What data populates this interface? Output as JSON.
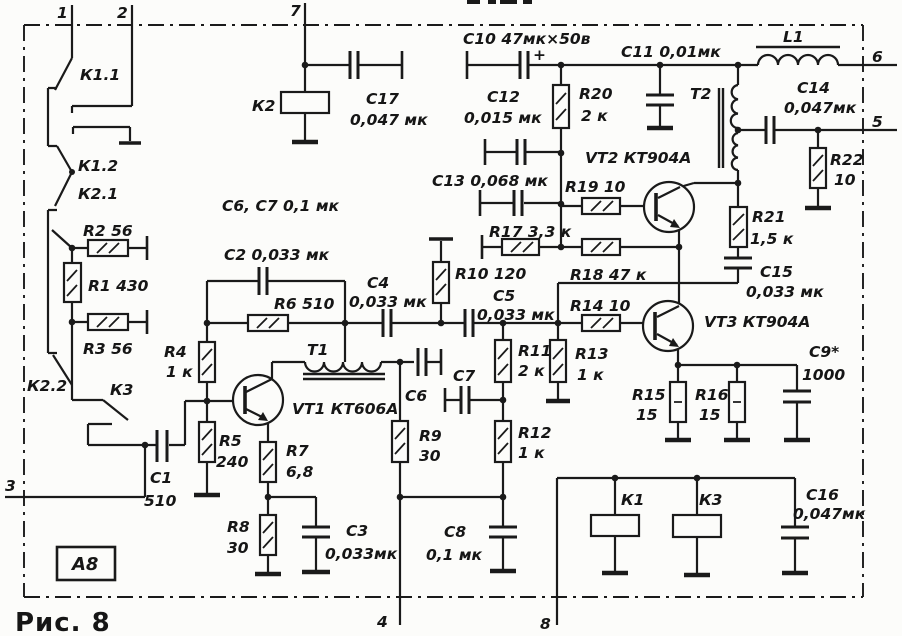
{
  "figure": {
    "caption": "Рис. 8",
    "module_label": "А8"
  },
  "labels": [
    {
      "n": "pin-1",
      "t": "1",
      "x": 57,
      "y": 18,
      "fs": 17
    },
    {
      "n": "pin-2",
      "t": "2",
      "x": 117,
      "y": 18,
      "fs": 17
    },
    {
      "n": "pin-7",
      "t": "7",
      "x": 290,
      "y": 16,
      "fs": 17
    },
    {
      "n": "pin-6",
      "t": "6",
      "x": 872,
      "y": 62,
      "fs": 17
    },
    {
      "n": "pin-5",
      "t": "5",
      "x": 872,
      "y": 127,
      "fs": 17
    },
    {
      "n": "pin-3",
      "t": "3",
      "x": 5,
      "y": 491,
      "fs": 17
    },
    {
      "n": "pin-4",
      "t": "4",
      "x": 377,
      "y": 627,
      "fs": 17
    },
    {
      "n": "pin-8",
      "t": "8",
      "x": 540,
      "y": 629,
      "fs": 17
    },
    {
      "n": "contact-K1-1",
      "t": "К1.1",
      "x": 80,
      "y": 80
    },
    {
      "n": "contact-K1-2",
      "t": "К1.2",
      "x": 78,
      "y": 171
    },
    {
      "n": "contact-K2-1",
      "t": "К2.1",
      "x": 78,
      "y": 199
    },
    {
      "n": "contact-K2-2",
      "t": "К2.2",
      "x": 27,
      "y": 391
    },
    {
      "n": "contact-K3",
      "t": "К3",
      "x": 110,
      "y": 395
    },
    {
      "n": "resistor-R2",
      "t": "R2 56",
      "x": 83,
      "y": 236
    },
    {
      "n": "resistor-R1",
      "t": "R1 430",
      "x": 88,
      "y": 291
    },
    {
      "n": "resistor-R3",
      "t": "R3 56",
      "x": 83,
      "y": 354
    },
    {
      "n": "capacitor-C1",
      "t": "С1",
      "x": 150,
      "y": 483
    },
    {
      "n": "capacitor-C1-val",
      "t": "510",
      "x": 144,
      "y": 506
    },
    {
      "n": "relay-K2",
      "t": "К2",
      "x": 252,
      "y": 111
    },
    {
      "n": "capacitor-C17",
      "t": "С17",
      "x": 366,
      "y": 104
    },
    {
      "n": "capacitor-C17-val",
      "t": "0,047 мк",
      "x": 350,
      "y": 125
    },
    {
      "n": "note-C6-C7",
      "t": "С6, С7  0,1 мк",
      "x": 222,
      "y": 211
    },
    {
      "n": "capacitor-C2",
      "t": "С2  0,033 мк",
      "x": 224,
      "y": 260
    },
    {
      "n": "resistor-R6",
      "t": "R6  510",
      "x": 274,
      "y": 309
    },
    {
      "n": "resistor-R4",
      "t": "R4",
      "x": 164,
      "y": 357
    },
    {
      "n": "resistor-R4-val",
      "t": "1 к",
      "x": 166,
      "y": 377
    },
    {
      "n": "resistor-R5",
      "t": "R5",
      "x": 219,
      "y": 446
    },
    {
      "n": "resistor-R5-val",
      "t": "240",
      "x": 216,
      "y": 467
    },
    {
      "n": "transistor-VT1",
      "t": "VT1  КТ606А",
      "x": 292,
      "y": 414
    },
    {
      "n": "transformer-T1",
      "t": "Т1",
      "x": 307,
      "y": 355
    },
    {
      "n": "resistor-R7",
      "t": "R7",
      "x": 286,
      "y": 456
    },
    {
      "n": "resistor-R7-val",
      "t": "6,8",
      "x": 286,
      "y": 477
    },
    {
      "n": "resistor-R8",
      "t": "R8",
      "x": 227,
      "y": 532
    },
    {
      "n": "resistor-R8-val",
      "t": "30",
      "x": 227,
      "y": 553
    },
    {
      "n": "capacitor-C3",
      "t": "С3",
      "x": 346,
      "y": 536
    },
    {
      "n": "capacitor-C3-val",
      "t": "0,033мк",
      "x": 325,
      "y": 559
    },
    {
      "n": "capacitor-C4",
      "t": "С4",
      "x": 367,
      "y": 288
    },
    {
      "n": "capacitor-C4-val",
      "t": "0,033 мк",
      "x": 349,
      "y": 307
    },
    {
      "n": "resistor-R10",
      "t": "R10 120",
      "x": 455,
      "y": 279
    },
    {
      "n": "capacitor-C5",
      "t": "С5",
      "x": 493,
      "y": 301
    },
    {
      "n": "capacitor-C5-val",
      "t": "0,033 мк",
      "x": 477,
      "y": 320
    },
    {
      "n": "capacitor-C6",
      "t": "С6",
      "x": 405,
      "y": 401
    },
    {
      "n": "capacitor-C7",
      "t": "С7",
      "x": 453,
      "y": 381
    },
    {
      "n": "resistor-R9",
      "t": "R9",
      "x": 419,
      "y": 441
    },
    {
      "n": "resistor-R9-val",
      "t": "30",
      "x": 419,
      "y": 461
    },
    {
      "n": "resistor-R11",
      "t": "R11",
      "x": 518,
      "y": 356
    },
    {
      "n": "resistor-R11-val",
      "t": "2 к",
      "x": 518,
      "y": 376
    },
    {
      "n": "resistor-R12",
      "t": "R12",
      "x": 518,
      "y": 438
    },
    {
      "n": "resistor-R12-val",
      "t": "1 к",
      "x": 518,
      "y": 458
    },
    {
      "n": "resistor-R13",
      "t": "R13",
      "x": 575,
      "y": 359
    },
    {
      "n": "resistor-R13-val",
      "t": "1 к",
      "x": 577,
      "y": 380
    },
    {
      "n": "capacitor-C8",
      "t": "С8",
      "x": 444,
      "y": 537
    },
    {
      "n": "capacitor-C8-val",
      "t": "0,1 мк",
      "x": 426,
      "y": 560
    },
    {
      "n": "resistor-R14",
      "t": "R14 10",
      "x": 570,
      "y": 311
    },
    {
      "n": "resistor-R18",
      "t": "R18 47 к",
      "x": 570,
      "y": 280
    },
    {
      "n": "resistor-R17",
      "t": "R17 3,3 к",
      "x": 489,
      "y": 237
    },
    {
      "n": "resistor-R19",
      "t": "R19 10",
      "x": 565,
      "y": 192
    },
    {
      "n": "capacitor-C13",
      "t": "С13 0,068 мк",
      "x": 432,
      "y": 186
    },
    {
      "n": "capacitor-C12",
      "t": "С12",
      "x": 487,
      "y": 102
    },
    {
      "n": "capacitor-C12-val",
      "t": "0,015 мк",
      "x": 464,
      "y": 123
    },
    {
      "n": "capacitor-C10",
      "t": "С10 47мк×50в",
      "x": 463,
      "y": 44
    },
    {
      "n": "capacitor-C10-plus",
      "t": "+",
      "x": 533,
      "y": 60
    },
    {
      "n": "resistor-R20",
      "t": "R20",
      "x": 579,
      "y": 99
    },
    {
      "n": "resistor-R20-val",
      "t": "2 к",
      "x": 581,
      "y": 121
    },
    {
      "n": "capacitor-C11",
      "t": "С11 0,01мк",
      "x": 621,
      "y": 57
    },
    {
      "n": "transistor-VT2",
      "t": "VT2 КТ904А",
      "x": 585,
      "y": 163
    },
    {
      "n": "transformer-T2",
      "t": "Т2",
      "x": 690,
      "y": 99
    },
    {
      "n": "inductor-L1",
      "t": "L1",
      "x": 783,
      "y": 42
    },
    {
      "n": "capacitor-C14",
      "t": "С14",
      "x": 797,
      "y": 93
    },
    {
      "n": "capacitor-C14-val",
      "t": "0,047мк",
      "x": 784,
      "y": 113
    },
    {
      "n": "resistor-R22",
      "t": "R22",
      "x": 830,
      "y": 165
    },
    {
      "n": "resistor-R22-val",
      "t": "10",
      "x": 834,
      "y": 185
    },
    {
      "n": "resistor-R21",
      "t": "R21",
      "x": 752,
      "y": 222
    },
    {
      "n": "resistor-R21-val",
      "t": "1,5 к",
      "x": 750,
      "y": 244
    },
    {
      "n": "capacitor-C15",
      "t": "С15",
      "x": 760,
      "y": 277
    },
    {
      "n": "capacitor-C15-val",
      "t": "0,033 мк",
      "x": 746,
      "y": 297
    },
    {
      "n": "transistor-VT3",
      "t": "VT3 КТ904А",
      "x": 704,
      "y": 327
    },
    {
      "n": "capacitor-C9",
      "t": "С9*",
      "x": 809,
      "y": 357
    },
    {
      "n": "capacitor-C9-val",
      "t": "1000",
      "x": 802,
      "y": 380
    },
    {
      "n": "resistor-R15",
      "t": "R15",
      "x": 632,
      "y": 400
    },
    {
      "n": "resistor-R15-val",
      "t": "15",
      "x": 636,
      "y": 420
    },
    {
      "n": "resistor-R16",
      "t": "R16",
      "x": 695,
      "y": 400
    },
    {
      "n": "resistor-R16-val",
      "t": "15",
      "x": 699,
      "y": 420
    },
    {
      "n": "relay-K1",
      "t": "К1",
      "x": 621,
      "y": 505
    },
    {
      "n": "relay-K3",
      "t": "К3",
      "x": 699,
      "y": 505
    },
    {
      "n": "capacitor-C16",
      "t": "С16",
      "x": 806,
      "y": 500
    },
    {
      "n": "capacitor-C16-val",
      "t": "0,047мк",
      "x": 793,
      "y": 519
    }
  ]
}
